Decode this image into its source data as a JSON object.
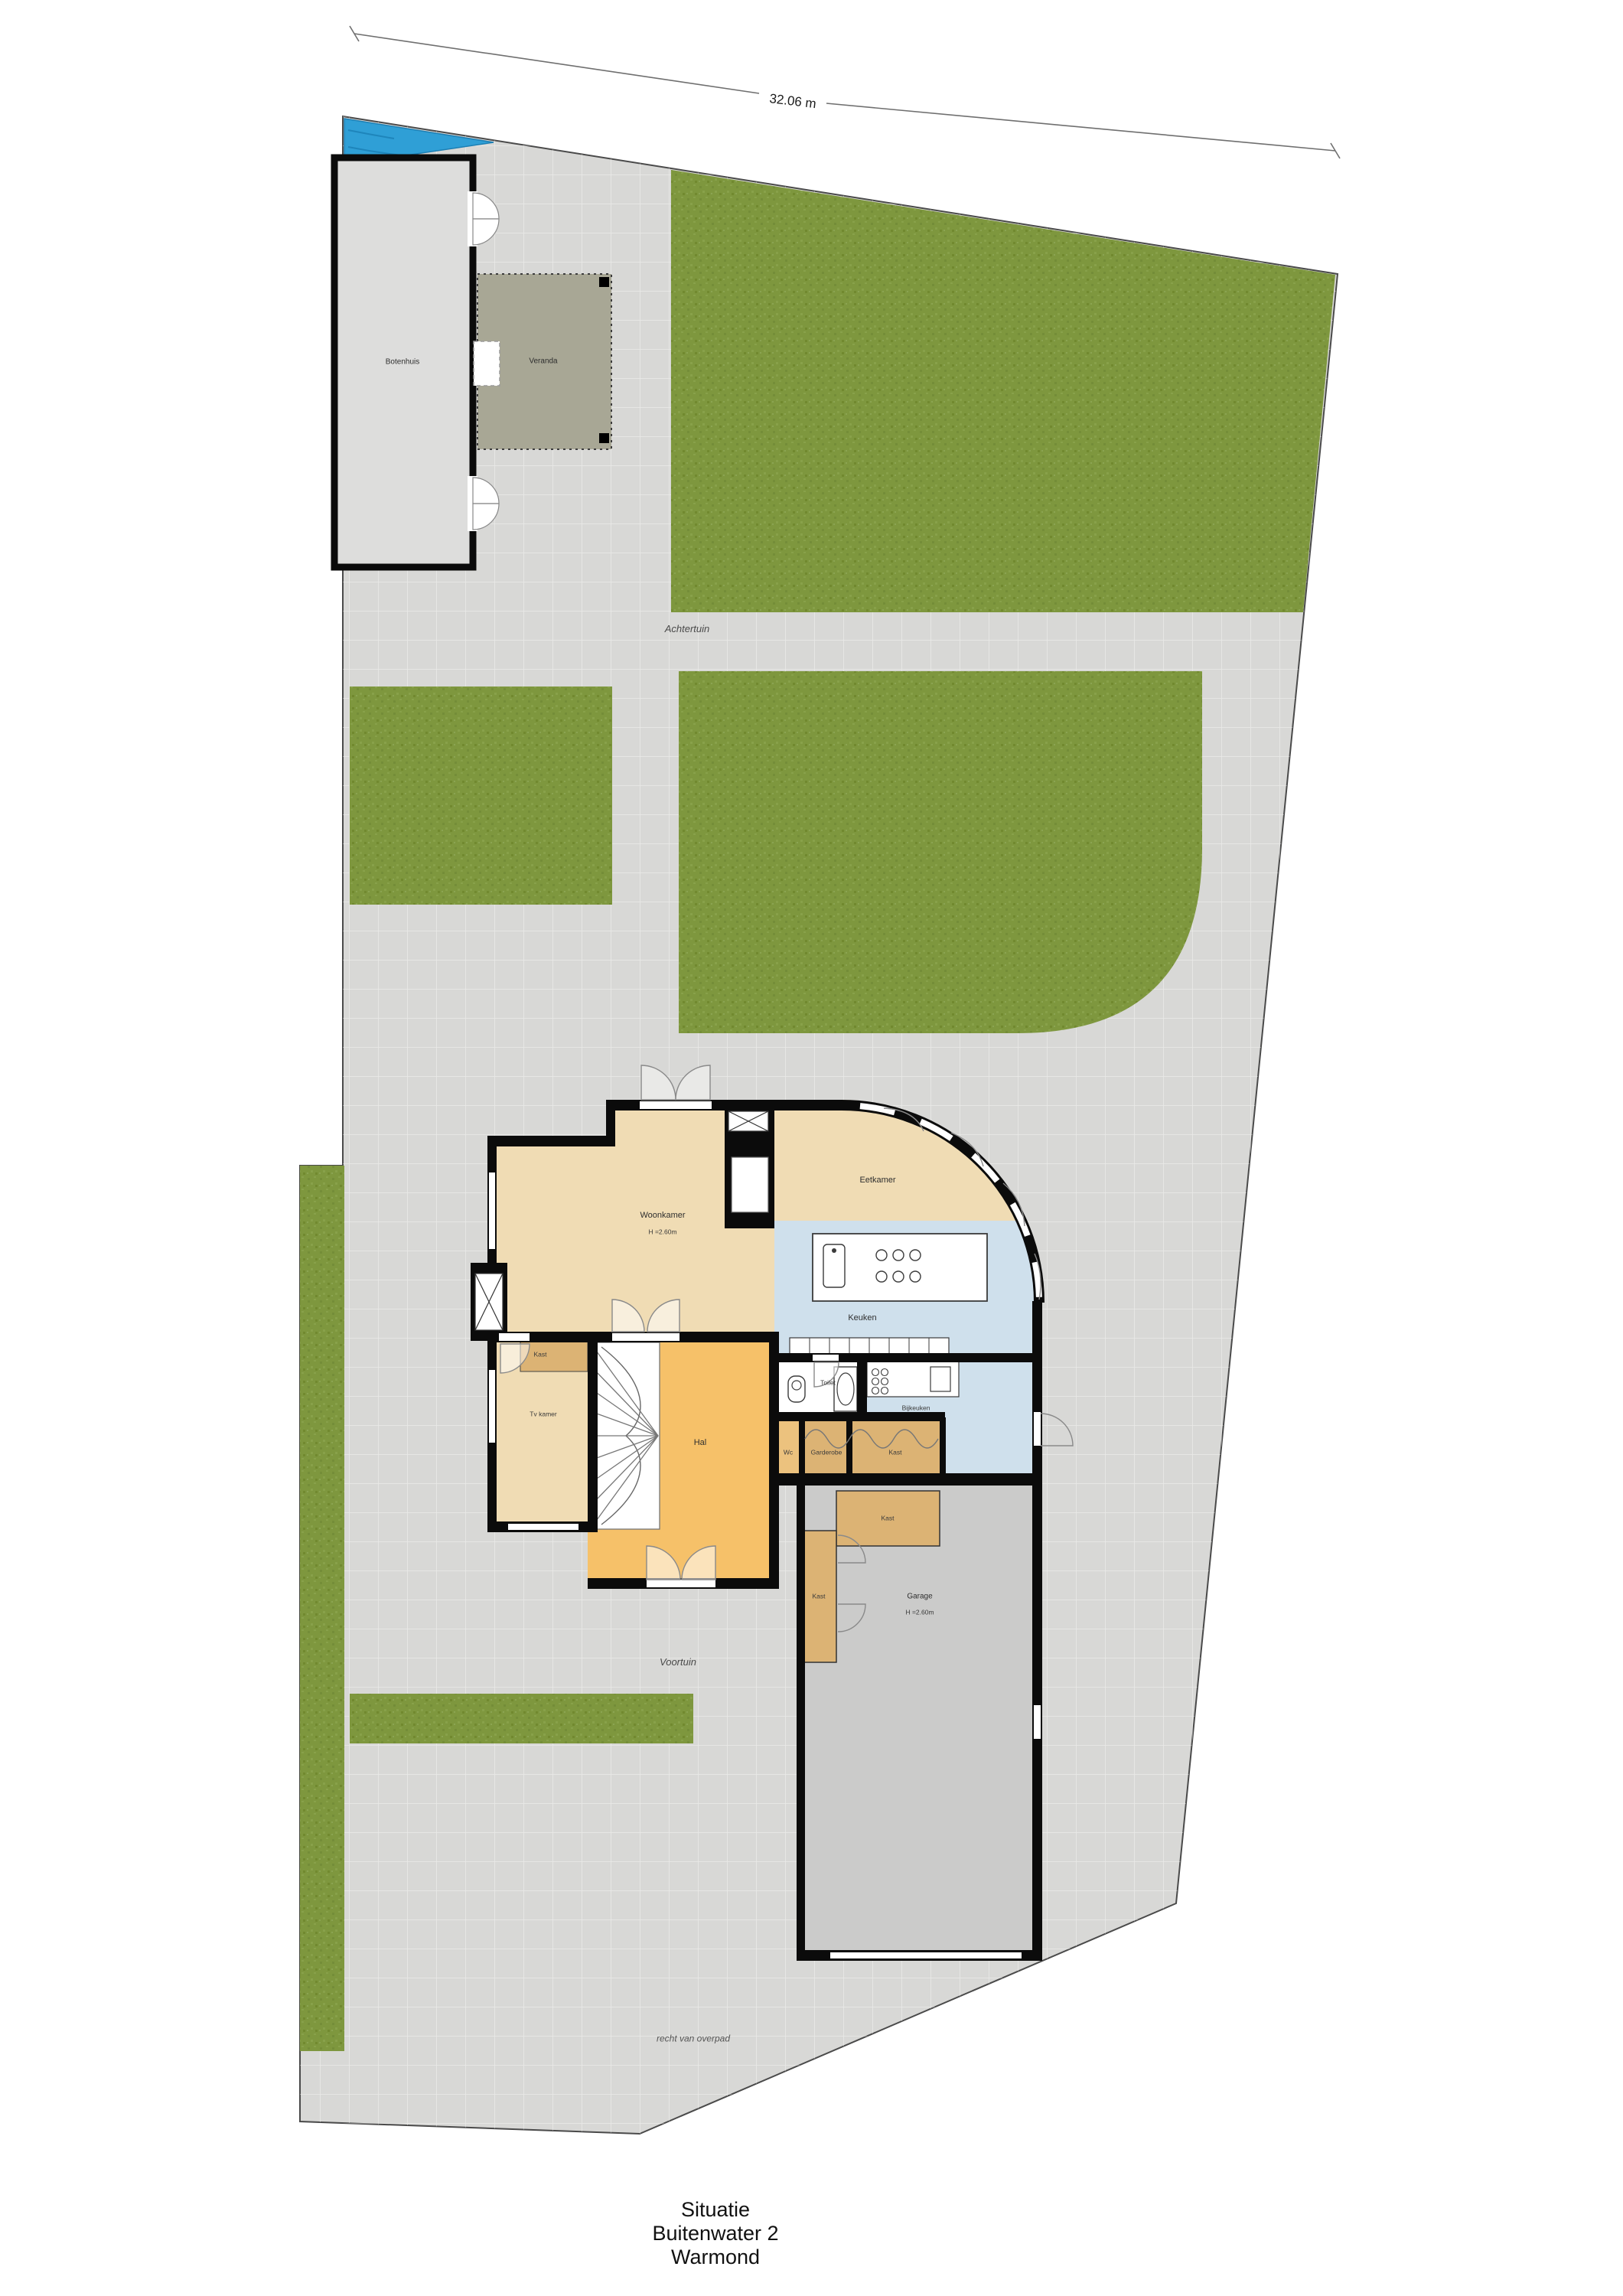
{
  "plan": {
    "type": "situation-floorplan",
    "dimension_top": "32.06 m",
    "title": {
      "line1": "Situatie",
      "line2": "Buitenwater 2",
      "line3": "Warmond"
    },
    "site_labels": {
      "achtertuin": "Achtertuin",
      "voortuin": "Voortuin",
      "overpad": "recht van overpad"
    },
    "outbuilding": {
      "botenhuis": "Botenhuis",
      "veranda": "Veranda"
    },
    "rooms": {
      "woonkamer": "Woonkamer",
      "woonkamer_height": "H =2.60m",
      "eetkamer": "Eetkamer",
      "tvkamer": "Tv kamer",
      "keuken": "Keuken",
      "bijkeuken": "Bijkeuken",
      "toilet": "Toilet",
      "hal": "Hal",
      "wc": "Wc",
      "garderobe": "Garderobe",
      "kast": "Kast",
      "garage": "Garage",
      "garage_height": "H =2.60m"
    },
    "colors": {
      "pavement": "#d8d8d6",
      "grass": "#7e973e",
      "water": "#2f9fd6",
      "room_tan": "#f0dcb4",
      "hall_orange": "#f6c169",
      "kitchen_blue": "#cfe0ec",
      "closet_brown": "#dcb374",
      "garage_gray": "#cbcbca",
      "veranda_olive": "#a8a795",
      "walls": "#0b0b0b"
    }
  }
}
